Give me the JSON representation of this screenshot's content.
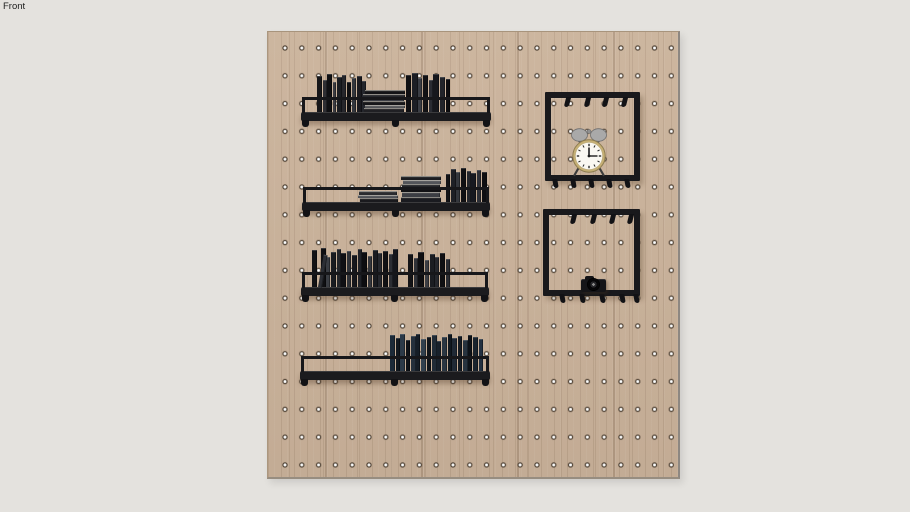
{
  "viewport": {
    "label": "Front"
  },
  "colors": {
    "background": "#e4e2de",
    "board_wood": "#cab29a",
    "metal_black": "#1b1b1e",
    "hole_ring": "#584a3c",
    "clock_brass": "#c6b075",
    "clock_face": "#faf8f2",
    "bell_gray": "#a9a9a9"
  },
  "scene": {
    "board": {
      "left": 267,
      "top": 31,
      "width": 413,
      "height": 448,
      "hole_grid": {
        "cols": 24,
        "rows": 16,
        "dx": 16.8,
        "dy": 27.8
      }
    },
    "shelves": [
      {
        "left": 301,
        "bar_top": 112,
        "width": 190,
        "groups": [
          {
            "type": "v",
            "x": 16,
            "books": [
              [
                5,
                36,
                "#17171a"
              ],
              [
                4,
                32,
                "#2e2e33"
              ],
              [
                5,
                38,
                "#101013"
              ],
              [
                3,
                30,
                "#3c3c42"
              ],
              [
                5,
                35,
                "#1b1d22"
              ],
              [
                4,
                37,
                "#26262b"
              ],
              [
                4,
                30,
                "#0e0e11"
              ],
              [
                4,
                34,
                "#33363c"
              ],
              [
                5,
                36,
                "#1a1a1f"
              ],
              [
                4,
                31,
                "#24262c"
              ]
            ]
          },
          {
            "type": "h",
            "x": 62,
            "w": 42,
            "stack": [
              [
                4,
                "#141417",
                2
              ],
              [
                4,
                "#26272c",
                0
              ],
              [
                3,
                "#3f4147",
                1
              ],
              [
                4,
                "#17171a",
                0
              ],
              [
                3,
                "#55565a",
                2
              ],
              [
                4,
                "#202024",
                1
              ]
            ]
          },
          {
            "type": "v",
            "x": 105,
            "books": [
              [
                5,
                37,
                "#0f0f12"
              ],
              [
                6,
                39,
                "#1c1e24"
              ],
              [
                4,
                34,
                "#3a3d44"
              ],
              [
                5,
                37,
                "#121215"
              ],
              [
                4,
                32,
                "#2a2c33"
              ],
              [
                6,
                38,
                "#17181d"
              ],
              [
                5,
                35,
                "#22242a"
              ],
              [
                4,
                33,
                "#0d0d10"
              ]
            ]
          }
        ]
      },
      {
        "left": 302,
        "bar_top": 202,
        "width": 188,
        "groups": [
          {
            "type": "h",
            "x": 56,
            "w": 40,
            "stack": [
              [
                4,
                "#2a2b2f",
                1
              ],
              [
                3,
                "#505257",
                0
              ],
              [
                4,
                "#1a1a1e",
                2
              ]
            ]
          },
          {
            "type": "h",
            "x": 99,
            "w": 40,
            "stack": [
              [
                4,
                "#1c1d21",
                0
              ],
              [
                4,
                "#53555a",
                2
              ],
              [
                4,
                "#232428",
                1
              ],
              [
                4,
                "#121215",
                0
              ],
              [
                5,
                "#3c3e44",
                1
              ],
              [
                5,
                "#1a1b20",
                0
              ]
            ]
          },
          {
            "type": "v",
            "x": 144,
            "books": [
              [
                4,
                28,
                "#131316"
              ],
              [
                5,
                33,
                "#1e2026"
              ],
              [
                4,
                30,
                "#34373d"
              ],
              [
                5,
                34,
                "#101013"
              ],
              [
                4,
                31,
                "#24262c"
              ],
              [
                5,
                29,
                "#171920"
              ],
              [
                4,
                32,
                "#2d3038"
              ],
              [
                5,
                30,
                "#0e0e11"
              ]
            ]
          }
        ]
      },
      {
        "left": 301,
        "bar_top": 287,
        "width": 188,
        "groups": [
          {
            "type": "v",
            "x": 11,
            "books": [
              [
                5,
                37,
                "#121215"
              ],
              [
                4,
                33,
                "#2c2e34",
                1
              ],
              [
                5,
                39,
                "#0f0f12"
              ],
              [
                4,
                30,
                "#3a3d43"
              ],
              [
                5,
                35,
                "#1a1c21"
              ],
              [
                4,
                38,
                "#24262b"
              ],
              [
                5,
                34,
                "#101014"
              ],
              [
                4,
                36,
                "#2f3238"
              ],
              [
                5,
                32,
                "#16171c"
              ],
              [
                4,
                38,
                "#202228"
              ],
              [
                5,
                35,
                "#0d0d10"
              ],
              [
                4,
                31,
                "#34363c"
              ],
              [
                5,
                37,
                "#191b20"
              ],
              [
                4,
                34,
                "#26282e"
              ],
              [
                5,
                36,
                "#111114"
              ],
              [
                4,
                33,
                "#2b2d33"
              ],
              [
                5,
                38,
                "#15161b"
              ]
            ]
          },
          {
            "type": "v",
            "x": 107,
            "books": [
              [
                5,
                33,
                "#141417"
              ],
              [
                4,
                29,
                "#303238"
              ],
              [
                6,
                35,
                "#0f0f12"
              ],
              [
                4,
                27,
                "#3c3e44"
              ],
              [
                5,
                33,
                "#1b1d22"
              ],
              [
                4,
                30,
                "#25272d"
              ],
              [
                5,
                34,
                "#101013"
              ],
              [
                4,
                28,
                "#2a2c32"
              ]
            ]
          }
        ]
      },
      {
        "left": 300,
        "bar_top": 371,
        "width": 190,
        "groups": [
          {
            "type": "v",
            "x": 90,
            "books": [
              [
                5,
                36,
                "#1c2a38"
              ],
              [
                4,
                33,
                "#11181f"
              ],
              [
                5,
                37,
                "#2c3a48"
              ],
              [
                4,
                31,
                "#0e1217"
              ],
              [
                5,
                35,
                "#25303c"
              ],
              [
                4,
                37,
                "#151d26"
              ],
              [
                5,
                32,
                "#31404e"
              ],
              [
                4,
                34,
                "#0f141a"
              ],
              [
                5,
                36,
                "#202b36"
              ],
              [
                4,
                30,
                "#18212b"
              ],
              [
                5,
                34,
                "#2a3642"
              ],
              [
                4,
                37,
                "#101820"
              ],
              [
                5,
                33,
                "#1f2935"
              ],
              [
                4,
                35,
                "#141b23"
              ],
              [
                5,
                31,
                "#27333f"
              ],
              [
                4,
                36,
                "#0d1218"
              ],
              [
                5,
                34,
                "#1a242e"
              ],
              [
                4,
                32,
                "#233040"
              ]
            ]
          }
        ]
      }
    ],
    "frames": [
      {
        "left": 545,
        "top": 92,
        "w": 95,
        "h": 89,
        "top_hooks": [
          14,
          34,
          52,
          71
        ],
        "bottom_hooks": [
          8,
          26,
          44,
          62,
          80
        ],
        "holds": "alarm-clock"
      },
      {
        "left": 543,
        "top": 209,
        "w": 97,
        "h": 87,
        "top_hooks": [
          22,
          42,
          61,
          79
        ],
        "bottom_hooks": [
          17,
          37,
          57,
          77,
          91
        ],
        "holds": "camera"
      }
    ],
    "clock": {
      "left": 566,
      "top": 127,
      "width": 46,
      "height": 50,
      "time": "12:15"
    },
    "camera": {
      "left": 581,
      "top": 276,
      "width": 25,
      "height": 16
    }
  }
}
